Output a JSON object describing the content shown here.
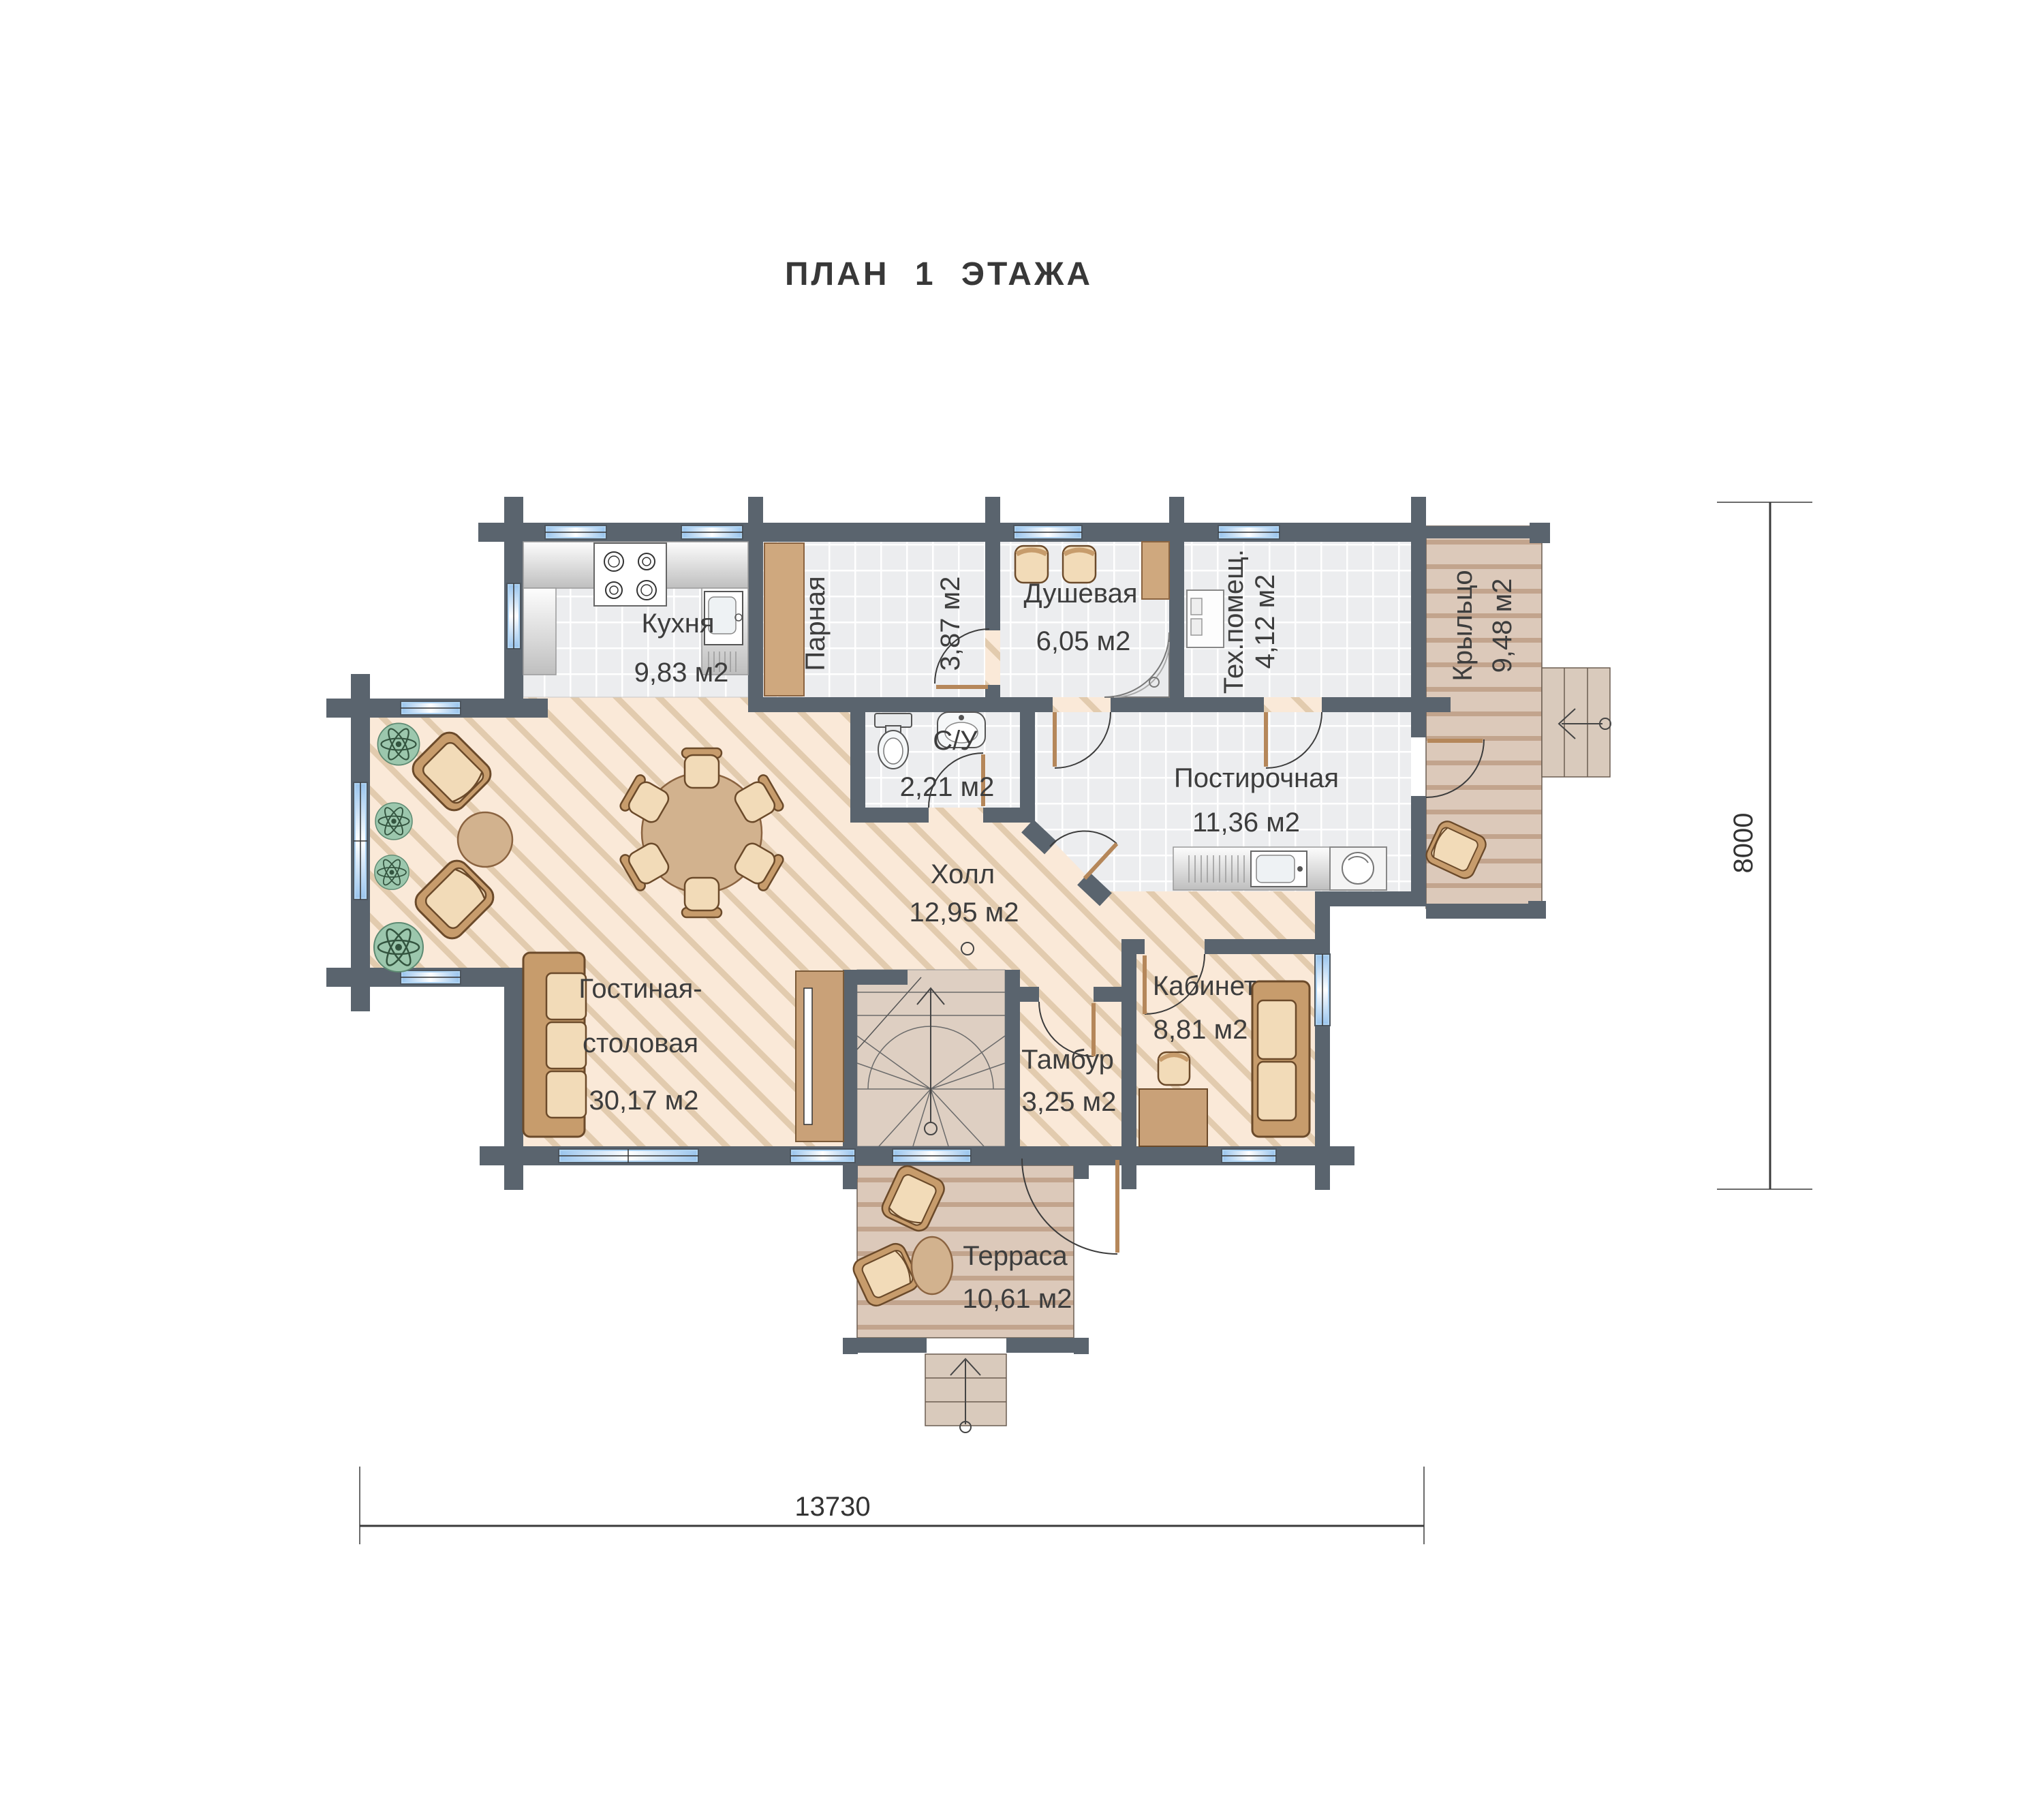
{
  "title": "ПЛАН 1 ЭТАЖА",
  "rooms": {
    "kitchen": {
      "name": "Кухня",
      "area": "9,83 м2"
    },
    "steam_room": {
      "name": "Парная",
      "area": "3,87 м2"
    },
    "shower_room": {
      "name": "Душевая",
      "area": "6,05 м2"
    },
    "tech_room": {
      "name": "Тех.помещ.",
      "area": "4,12 м2"
    },
    "porch": {
      "name": "Крыльцо",
      "area": "9,48 м2"
    },
    "wc": {
      "name": "С/У",
      "area": "2,21 м2"
    },
    "laundry": {
      "name": "Постирочная",
      "area": "11,36 м2"
    },
    "hall": {
      "name": "Холл",
      "area": "12,95 м2"
    },
    "living_dining": {
      "name_line1": "Гостиная-",
      "name_line2": "столовая",
      "area": "30,17 м2"
    },
    "vestibule": {
      "name": "Тамбур",
      "area": "3,25 м2"
    },
    "office": {
      "name": "Кабинет",
      "area": "8,81 м2"
    },
    "terrace": {
      "name": "Терраса",
      "area": "10,61 м2"
    }
  },
  "dimensions": {
    "overall_width_mm": "13730",
    "overall_height_mm": "8000"
  },
  "colors": {
    "wall": "#5a646e",
    "window": "#aed3f2",
    "floor_hall": "#fae9d8",
    "floor_stripe": "#e2cbae",
    "floor_tile": "#ecedef",
    "deck": "#dcc9ba",
    "deck_stripe": "#c2a48d",
    "furniture": "#f2dbb8",
    "furniture_frame": "#c79c6c",
    "plant": "#9cc7ad",
    "text": "#3d3d3d"
  }
}
